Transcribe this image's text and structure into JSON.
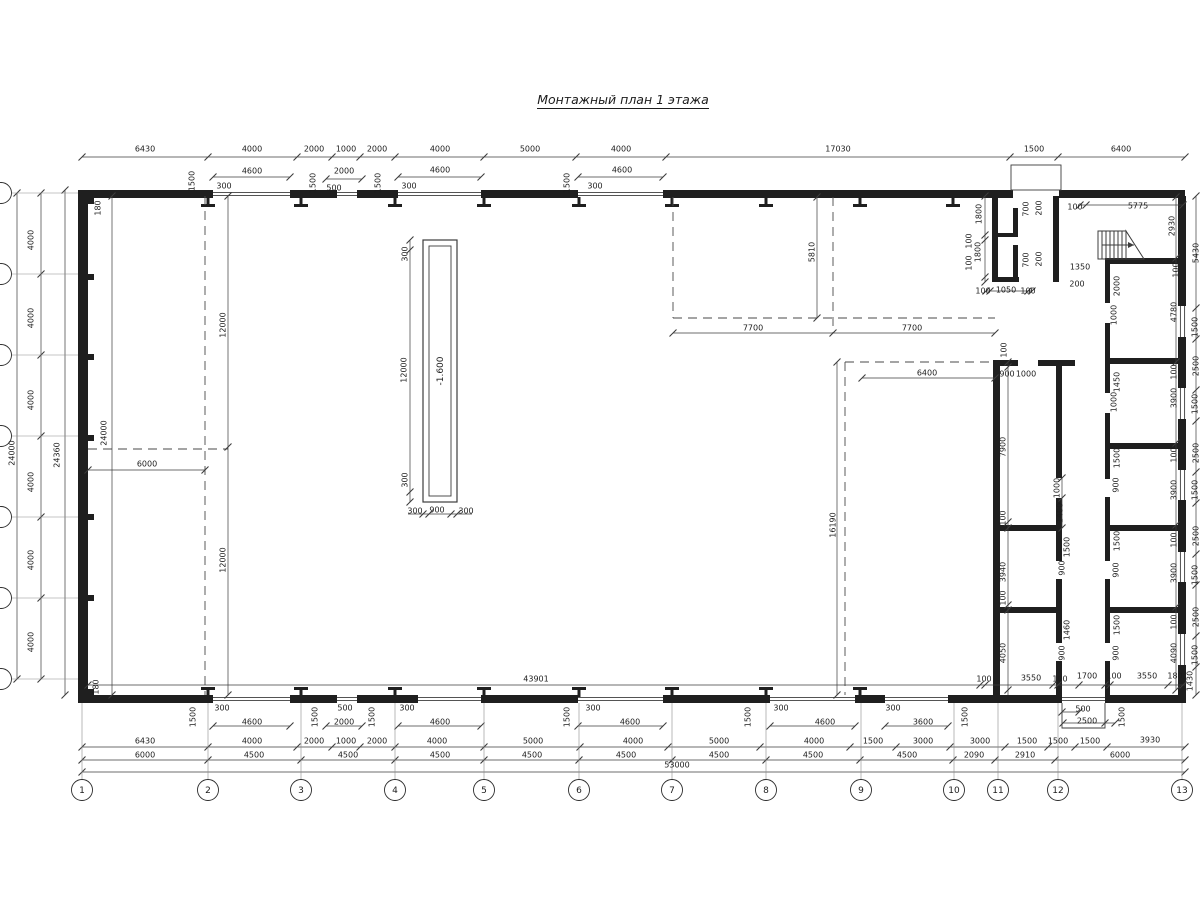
{
  "title": "Монтажный план 1 этажа",
  "pit": {
    "depth_label": "-1.600"
  },
  "colors": {
    "wall": "#1f1f1f",
    "dim_line": "#3c3c3c",
    "dash_line": "#4a4a4a",
    "text": "#1c1c1c",
    "background": "#ffffff"
  },
  "labels": [
    [
      "6430",
      145,
      149,
      0
    ],
    [
      "4000",
      252,
      149,
      0
    ],
    [
      "2000",
      314,
      149,
      0
    ],
    [
      "1000",
      346,
      149,
      0
    ],
    [
      "2000",
      377,
      149,
      0
    ],
    [
      "4000",
      440,
      149,
      0
    ],
    [
      "5000",
      530,
      149,
      0
    ],
    [
      "4000",
      621,
      149,
      0
    ],
    [
      "17030",
      838,
      149,
      0
    ],
    [
      "1500",
      1034,
      149,
      0
    ],
    [
      "6400",
      1121,
      149,
      0
    ],
    [
      "4600",
      252,
      171,
      0
    ],
    [
      "2000",
      344,
      171,
      0
    ],
    [
      "4600",
      440,
      170,
      0
    ],
    [
      "4600",
      622,
      170,
      0
    ],
    [
      "1500",
      192,
      181,
      1
    ],
    [
      "1500",
      313,
      183,
      1
    ],
    [
      "1500",
      378,
      183,
      1
    ],
    [
      "1500",
      567,
      183,
      1
    ],
    [
      "300",
      224,
      186,
      0
    ],
    [
      "500",
      334,
      188,
      0
    ],
    [
      "300",
      409,
      186,
      0
    ],
    [
      "300",
      595,
      186,
      0
    ],
    [
      "1800",
      979,
      214,
      1
    ],
    [
      "700",
      1026,
      209,
      1
    ],
    [
      "200",
      1039,
      208,
      1
    ],
    [
      "100",
      969,
      241,
      1
    ],
    [
      "1800",
      978,
      252,
      1
    ],
    [
      "100",
      969,
      263,
      1
    ],
    [
      "700",
      1026,
      260,
      1
    ],
    [
      "200",
      1039,
      259,
      1
    ],
    [
      "100",
      983,
      291,
      0
    ],
    [
      "1050",
      1006,
      290,
      0
    ],
    [
      "100",
      1028,
      291,
      0
    ],
    [
      "100",
      1075,
      207,
      0
    ],
    [
      "5775",
      1138,
      206,
      0
    ],
    [
      "1350",
      1080,
      267,
      0
    ],
    [
      "200",
      1077,
      284,
      0
    ],
    [
      "2930",
      1172,
      226,
      1
    ],
    [
      "2000",
      1117,
      286,
      1
    ],
    [
      "1000",
      1114,
      315,
      1
    ],
    [
      "100",
      1176,
      270,
      1
    ],
    [
      "4780",
      1174,
      312,
      1
    ],
    [
      "1450",
      1117,
      382,
      1
    ],
    [
      "1000",
      1114,
      402,
      1
    ],
    [
      "100",
      1174,
      372,
      1
    ],
    [
      "3900",
      1174,
      398,
      1
    ],
    [
      "1500",
      1117,
      458,
      1
    ],
    [
      "900",
      1116,
      485,
      1
    ],
    [
      "100",
      1174,
      455,
      1
    ],
    [
      "3900",
      1174,
      490,
      1
    ],
    [
      "1500",
      1117,
      541,
      1
    ],
    [
      "900",
      1116,
      570,
      1
    ],
    [
      "100",
      1174,
      540,
      1
    ],
    [
      "3900",
      1174,
      573,
      1
    ],
    [
      "1500",
      1117,
      625,
      1
    ],
    [
      "900",
      1116,
      653,
      1
    ],
    [
      "100",
      1174,
      622,
      1
    ],
    [
      "4090",
      1174,
      653,
      1
    ],
    [
      "5430",
      1196,
      253,
      1
    ],
    [
      "1500",
      1195,
      327,
      1
    ],
    [
      "2500",
      1196,
      366,
      1
    ],
    [
      "1500",
      1195,
      404,
      1
    ],
    [
      "2500",
      1196,
      453,
      1
    ],
    [
      "1500",
      1195,
      490,
      1
    ],
    [
      "2500",
      1196,
      536,
      1
    ],
    [
      "1500",
      1195,
      575,
      1
    ],
    [
      "2500",
      1196,
      617,
      1
    ],
    [
      "1500",
      1195,
      655,
      1
    ],
    [
      "1430",
      1190,
      681,
      1
    ],
    [
      "100",
      1004,
      350,
      1
    ],
    [
      "900",
      1007,
      374,
      0
    ],
    [
      "1000",
      1026,
      374,
      0
    ],
    [
      "6400",
      927,
      373,
      0
    ],
    [
      "7900",
      1003,
      447,
      1
    ],
    [
      "100",
      1003,
      518,
      1
    ],
    [
      "1000",
      1057,
      488,
      1
    ],
    [
      "1400",
      1060,
      513,
      1
    ],
    [
      "3940",
      1003,
      572,
      1
    ],
    [
      "100",
      1003,
      598,
      1
    ],
    [
      "4050",
      1003,
      653,
      1
    ],
    [
      "1500",
      1067,
      547,
      1
    ],
    [
      "900",
      1062,
      568,
      1
    ],
    [
      "1460",
      1067,
      630,
      1
    ],
    [
      "900",
      1062,
      653,
      1
    ],
    [
      "16190",
      833,
      525,
      1
    ],
    [
      "7700",
      753,
      328,
      0
    ],
    [
      "7700",
      912,
      328,
      0
    ],
    [
      "5810",
      812,
      252,
      1
    ],
    [
      "4000",
      31,
      240,
      1
    ],
    [
      "4000",
      31,
      318,
      1
    ],
    [
      "4000",
      31,
      400,
      1
    ],
    [
      "4000",
      31,
      482,
      1
    ],
    [
      "4000",
      31,
      560,
      1
    ],
    [
      "4000",
      31,
      642,
      1
    ],
    [
      "24000",
      12,
      453,
      1
    ],
    [
      "24360",
      57,
      455,
      1
    ],
    [
      "24000",
      104,
      433,
      1
    ],
    [
      "12000",
      223,
      325,
      1
    ],
    [
      "12000",
      223,
      560,
      1
    ],
    [
      "6000",
      147,
      464,
      0
    ],
    [
      "180",
      98,
      208,
      1
    ],
    [
      "180",
      96,
      687,
      1
    ],
    [
      "300",
      405,
      254,
      1
    ],
    [
      "12000",
      404,
      370,
      1
    ],
    [
      "300",
      405,
      480,
      1
    ],
    [
      "300",
      415,
      511,
      0
    ],
    [
      "900",
      437,
      510,
      0
    ],
    [
      "300",
      466,
      511,
      0
    ],
    [
      "1500",
      193,
      717,
      1
    ],
    [
      "300",
      222,
      708,
      0
    ],
    [
      "4600",
      252,
      722,
      0
    ],
    [
      "1500",
      315,
      717,
      1
    ],
    [
      "500",
      345,
      708,
      0
    ],
    [
      "2000",
      344,
      722,
      0
    ],
    [
      "1500",
      372,
      717,
      1
    ],
    [
      "300",
      407,
      708,
      0
    ],
    [
      "4600",
      440,
      722,
      0
    ],
    [
      "1500",
      567,
      717,
      1
    ],
    [
      "300",
      593,
      708,
      0
    ],
    [
      "4600",
      630,
      722,
      0
    ],
    [
      "1500",
      748,
      717,
      1
    ],
    [
      "300",
      781,
      708,
      0
    ],
    [
      "4600",
      825,
      722,
      0
    ],
    [
      "300",
      893,
      708,
      0
    ],
    [
      "3600",
      923,
      722,
      0
    ],
    [
      "1500",
      965,
      717,
      1
    ],
    [
      "500",
      1083,
      709,
      0
    ],
    [
      "2500",
      1087,
      721,
      0
    ],
    [
      "1500",
      1122,
      717,
      1
    ],
    [
      "43901",
      536,
      679,
      0
    ],
    [
      "100",
      984,
      679,
      0
    ],
    [
      "3550",
      1031,
      678,
      0
    ],
    [
      "100",
      1060,
      679,
      0
    ],
    [
      "1700",
      1087,
      676,
      0
    ],
    [
      "100",
      1114,
      676,
      0
    ],
    [
      "3550",
      1147,
      676,
      0
    ],
    [
      "180",
      1175,
      676,
      0
    ],
    [
      "6430",
      145,
      741,
      0
    ],
    [
      "4000",
      252,
      741,
      0
    ],
    [
      "2000",
      314,
      741,
      0
    ],
    [
      "1000",
      346,
      741,
      0
    ],
    [
      "2000",
      377,
      741,
      0
    ],
    [
      "4000",
      437,
      741,
      0
    ],
    [
      "5000",
      533,
      741,
      0
    ],
    [
      "4000",
      633,
      741,
      0
    ],
    [
      "5000",
      719,
      741,
      0
    ],
    [
      "4000",
      814,
      741,
      0
    ],
    [
      "1500",
      873,
      741,
      0
    ],
    [
      "3000",
      923,
      741,
      0
    ],
    [
      "3000",
      980,
      741,
      0
    ],
    [
      "1500",
      1027,
      741,
      0
    ],
    [
      "1500",
      1058,
      741,
      0
    ],
    [
      "1500",
      1090,
      741,
      0
    ],
    [
      "3930",
      1150,
      740,
      0
    ],
    [
      "6000",
      145,
      755,
      0
    ],
    [
      "4500",
      254,
      755,
      0
    ],
    [
      "4500",
      348,
      755,
      0
    ],
    [
      "4500",
      440,
      755,
      0
    ],
    [
      "4500",
      532,
      755,
      0
    ],
    [
      "4500",
      626,
      755,
      0
    ],
    [
      "4500",
      719,
      755,
      0
    ],
    [
      "4500",
      813,
      755,
      0
    ],
    [
      "4500",
      907,
      755,
      0
    ],
    [
      "2090",
      974,
      755,
      0
    ],
    [
      "2910",
      1025,
      755,
      0
    ],
    [
      "6000",
      1120,
      755,
      0
    ],
    [
      "53000",
      677,
      765,
      0
    ]
  ],
  "grid_columns": [
    [
      "1",
      82
    ],
    [
      "2",
      208
    ],
    [
      "3",
      301
    ],
    [
      "4",
      395
    ],
    [
      "5",
      484
    ],
    [
      "6",
      579
    ],
    [
      "7",
      672
    ],
    [
      "8",
      766
    ],
    [
      "9",
      861
    ],
    [
      "10",
      954
    ],
    [
      "11",
      998
    ],
    [
      "12",
      1058
    ],
    [
      "13",
      1182
    ]
  ],
  "grid_rows_y": [
    193,
    274,
    355,
    436,
    517,
    598,
    679
  ]
}
